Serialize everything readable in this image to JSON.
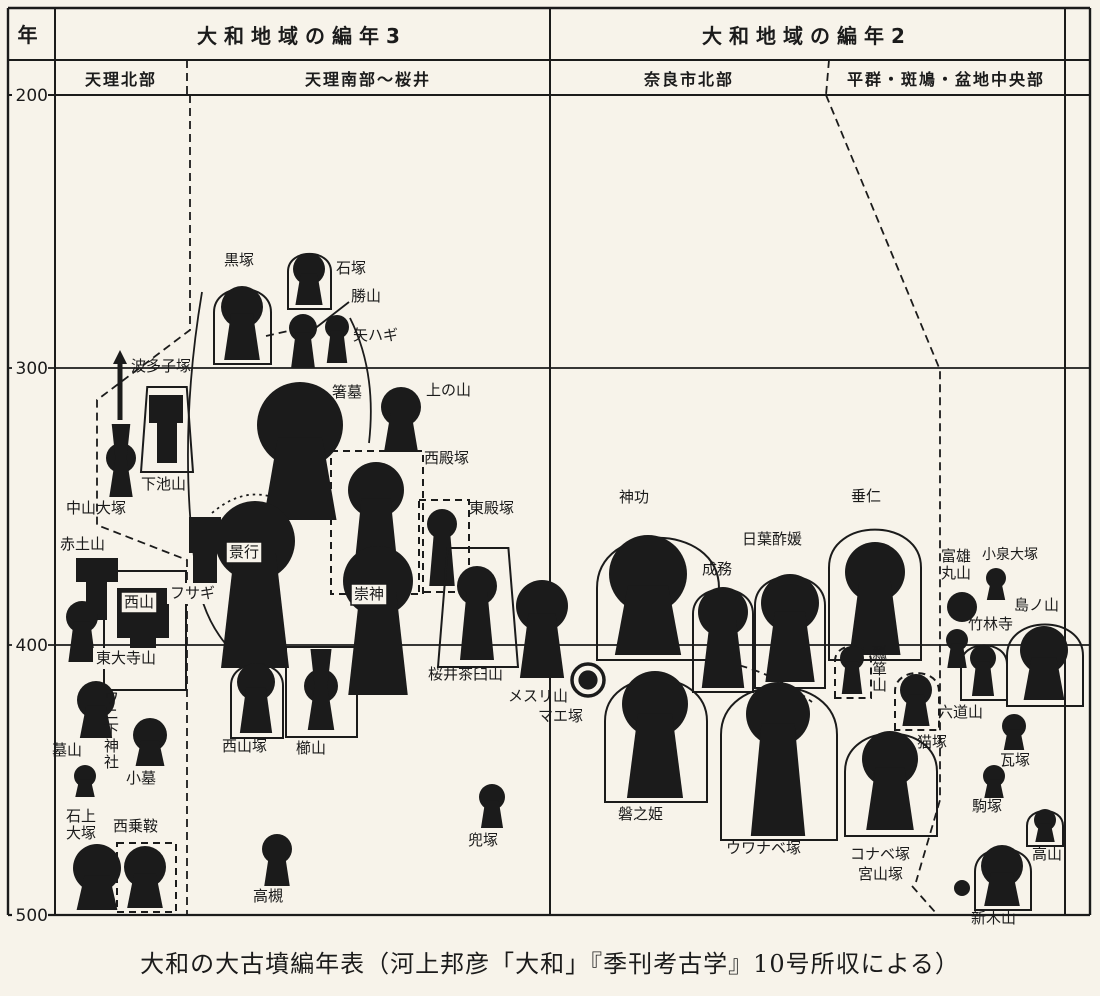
{
  "colors": {
    "paper": "#f7f3ea",
    "ink": "#1b1b1b"
  },
  "caption": "大和の大古墳編年表（河上邦彦「大和」『季刊考古学』10号所収による）",
  "axis": {
    "unit_label": "年",
    "ticks": [
      {
        "label": "200",
        "y": 95
      },
      {
        "label": "300",
        "y": 368
      },
      {
        "label": "400",
        "y": 645
      },
      {
        "label": "500",
        "y": 915
      }
    ]
  },
  "headers": {
    "col_left_title": "大和地域の編年3",
    "col_right_title": "大和地域の編年2",
    "sub_headers": [
      {
        "label": "天理北部",
        "cx": 121
      },
      {
        "label": "天理南部～桜井",
        "cx": 368
      },
      {
        "label": "奈良市北部",
        "cx": 689
      },
      {
        "label": "平群・斑鳩・盆地中央部",
        "cx": 946
      }
    ]
  },
  "tombs": [
    {
      "lb": "波多子塚",
      "t": "a",
      "x": 120,
      "y1": 352,
      "y2": 420,
      "lx": 131,
      "ly": 358
    },
    {
      "lb": "下池山",
      "t": "t",
      "bar": [
        149,
        395,
        34,
        28
      ],
      "col": [
        157,
        423,
        20,
        40
      ],
      "o": {
        "s": "trap",
        "x1": 141,
        "y1": 387,
        "x2": 193,
        "y2": 472
      },
      "lx": 141,
      "ly": 476
    },
    {
      "lb": "中山大塚",
      "t": "h",
      "cx": 121,
      "cy": 458,
      "r": 15,
      "top": 424,
      "b": 497,
      "lx": 66,
      "ly": 500
    },
    {
      "lb": "赤土山",
      "t": "t",
      "bar": [
        76,
        558,
        42,
        24
      ],
      "col": [
        86,
        582,
        21,
        38
      ],
      "lx": 60,
      "ly": 536
    },
    {
      "lb": "西山",
      "t": "t",
      "bar": [
        117,
        588,
        52,
        50
      ],
      "col": [
        130,
        638,
        26,
        18
      ],
      "o": {
        "s": "rect",
        "x1": 104,
        "y1": 571,
        "x2": 186,
        "y2": 690
      },
      "lx": 124,
      "ly": 594,
      "box": "box"
    },
    {
      "lb": "東大寺山",
      "t": "n",
      "lx": 96,
      "ly": 650,
      "box": "bg"
    },
    {
      "lb": "",
      "t": "k",
      "cx": 82,
      "cy": 617,
      "r": 16,
      "b": 662
    },
    {
      "lb": "墓山",
      "t": "k",
      "cx": 96,
      "cy": 700,
      "r": 19,
      "b": 738,
      "lx": 52,
      "ly": 742
    },
    {
      "lb": "ワニ下神社",
      "t": "n",
      "lx": 104,
      "ly": 690,
      "lv": true
    },
    {
      "lb": "小墓",
      "t": "k",
      "cx": 150,
      "cy": 735,
      "r": 17,
      "b": 766,
      "lx": 126,
      "ly": 770
    },
    {
      "lb": "",
      "t": "k",
      "cx": 85,
      "cy": 776,
      "r": 11,
      "b": 797
    },
    {
      "lb": "石上\n大塚",
      "t": "k",
      "cx": 97,
      "cy": 868,
      "r": 24,
      "b": 910,
      "lx": 66,
      "ly": 808,
      "l2": true
    },
    {
      "lb": "西乗鞍",
      "t": "k",
      "cx": 145,
      "cy": 867,
      "r": 21,
      "b": 908,
      "o": {
        "s": "rect",
        "x1": 117,
        "y1": 843,
        "x2": 176,
        "y2": 912,
        "dash": true
      },
      "lx": 113,
      "ly": 818
    },
    {
      "lb": "黒塚",
      "t": "k",
      "cx": 242,
      "cy": 307,
      "r": 21,
      "b": 360,
      "o": {
        "s": "arch",
        "x1": 214,
        "y1": 281,
        "x2": 271,
        "y2": 364
      },
      "lx": 224,
      "ly": 252
    },
    {
      "lb": "石塚",
      "t": "k",
      "cx": 309,
      "cy": 269,
      "r": 16,
      "b": 305,
      "o": {
        "s": "arch",
        "x1": 288,
        "y1": 248,
        "x2": 331,
        "y2": 309
      },
      "lx": 336,
      "ly": 260
    },
    {
      "lb": "勝山",
      "t": "k",
      "cx": 303,
      "cy": 328,
      "r": 14,
      "b": 368,
      "lx": 351,
      "ly": 288
    },
    {
      "lb": "矢ハギ",
      "t": "k",
      "cx": 337,
      "cy": 327,
      "r": 12,
      "b": 363,
      "lx": 353,
      "ly": 327
    },
    {
      "lb": "箸墓",
      "t": "k",
      "cx": 300,
      "cy": 425,
      "r": 43,
      "b": 520,
      "lx": 332,
      "ly": 384
    },
    {
      "lb": "上の山",
      "t": "k",
      "cx": 401,
      "cy": 407,
      "r": 20,
      "b": 452,
      "lx": 426,
      "ly": 382
    },
    {
      "lb": "西殿塚",
      "t": "k",
      "cx": 376,
      "cy": 490,
      "r": 28,
      "b": 588,
      "o": {
        "s": "rect",
        "x1": 331,
        "y1": 451,
        "x2": 423,
        "y2": 594,
        "dash": true
      },
      "lx": 424,
      "ly": 450
    },
    {
      "lb": "東殿塚",
      "t": "k",
      "cx": 442,
      "cy": 524,
      "r": 15,
      "b": 586,
      "o": {
        "s": "rect",
        "x1": 419,
        "y1": 500,
        "x2": 469,
        "y2": 592,
        "dash": true
      },
      "lx": 469,
      "ly": 500
    },
    {
      "lb": "景行",
      "t": "k",
      "cx": 255,
      "cy": 541,
      "r": 40,
      "b": 668,
      "lx": 229,
      "ly": 544,
      "box": "box"
    },
    {
      "lb": "フサギ",
      "t": "t",
      "bar": [
        189,
        517,
        32,
        36
      ],
      "col": [
        193,
        553,
        24,
        46
      ],
      "lx": 170,
      "ly": 585,
      "box": "bg"
    },
    {
      "lb": "崇神",
      "t": "k",
      "cx": 378,
      "cy": 581,
      "r": 35,
      "b": 695,
      "lx": 354,
      "ly": 586,
      "box": "box"
    },
    {
      "lb": "西山塚",
      "t": "k",
      "cx": 256,
      "cy": 682,
      "r": 19,
      "b": 733,
      "o": {
        "s": "arch",
        "x1": 231,
        "y1": 657,
        "x2": 283,
        "y2": 738
      },
      "lx": 222,
      "ly": 738
    },
    {
      "lb": "櫛山",
      "t": "h",
      "cx": 321,
      "cy": 686,
      "r": 17,
      "top": 649,
      "b": 730,
      "o": {
        "s": "rect",
        "x1": 286,
        "y1": 647,
        "x2": 357,
        "y2": 737
      },
      "lx": 296,
      "ly": 740
    },
    {
      "lb": "桜井茶臼山",
      "t": "k",
      "cx": 477,
      "cy": 586,
      "r": 20,
      "b": 660,
      "o": {
        "s": "trap",
        "x1": 438,
        "y1": 548,
        "x2": 518,
        "y2": 667
      },
      "lx": 428,
      "ly": 666
    },
    {
      "lb": "メスリ山",
      "t": "k",
      "cx": 542,
      "cy": 606,
      "r": 26,
      "b": 678,
      "lx": 508,
      "ly": 688
    },
    {
      "lb": "兜塚",
      "t": "k",
      "cx": 492,
      "cy": 797,
      "r": 13,
      "b": 828,
      "lx": 468,
      "ly": 832
    },
    {
      "lb": "高槻",
      "t": "k",
      "cx": 277,
      "cy": 849,
      "r": 15,
      "b": 886,
      "lx": 253,
      "ly": 888
    },
    {
      "lb": "マエ塚",
      "t": "r",
      "cx": 588,
      "cy": 680,
      "r": 16,
      "lx": 538,
      "ly": 708
    },
    {
      "lb": "神功",
      "t": "k",
      "cx": 648,
      "cy": 574,
      "r": 39,
      "b": 655,
      "o": {
        "s": "arch",
        "x1": 597,
        "y1": 521,
        "x2": 719,
        "y2": 660
      },
      "lx": 619,
      "ly": 489
    },
    {
      "lb": "磐之姫",
      "t": "k",
      "cx": 655,
      "cy": 704,
      "r": 33,
      "b": 798,
      "o": {
        "s": "arch",
        "x1": 605,
        "y1": 665,
        "x2": 707,
        "y2": 802
      },
      "lx": 618,
      "ly": 806
    },
    {
      "lb": "成務",
      "t": "k",
      "cx": 723,
      "cy": 612,
      "r": 25,
      "b": 688,
      "o": {
        "s": "arch",
        "x1": 693,
        "y1": 581,
        "x2": 753,
        "y2": 692
      },
      "lx": 702,
      "ly": 561
    },
    {
      "lb": "日葉酢媛",
      "t": "k",
      "cx": 790,
      "cy": 603,
      "r": 29,
      "b": 682,
      "o": {
        "s": "arch",
        "x1": 755,
        "y1": 567,
        "x2": 825,
        "y2": 688
      },
      "lx": 742,
      "ly": 531
    },
    {
      "lb": "垂仁",
      "t": "k",
      "cx": 875,
      "cy": 572,
      "r": 30,
      "b": 655,
      "o": {
        "s": "arch",
        "x1": 829,
        "y1": 517,
        "x2": 921,
        "y2": 660
      },
      "lx": 851,
      "ly": 488
    },
    {
      "lb": "ウワナベ塚",
      "t": "k",
      "cx": 778,
      "cy": 714,
      "r": 32,
      "b": 836,
      "o": {
        "s": "arch",
        "x1": 721,
        "y1": 671,
        "x2": 837,
        "y2": 840
      },
      "lx": 726,
      "ly": 840
    },
    {
      "lb": "コナベ塚",
      "t": "k",
      "cx": 890,
      "cy": 759,
      "r": 28,
      "b": 830,
      "o": {
        "s": "arch",
        "x1": 845,
        "y1": 721,
        "x2": 937,
        "y2": 836
      },
      "lx": 850,
      "ly": 846
    },
    {
      "lb": "瓢箪山",
      "t": "k",
      "cx": 852,
      "cy": 658,
      "r": 12,
      "b": 694,
      "o": {
        "s": "arch",
        "x1": 835,
        "y1": 641,
        "x2": 871,
        "y2": 698,
        "dash": true
      },
      "lx": 872,
      "ly": 645,
      "lv": true
    },
    {
      "lb": "猫塚",
      "t": "k",
      "cx": 916,
      "cy": 690,
      "r": 16,
      "b": 726,
      "o": {
        "s": "arch",
        "x1": 895,
        "y1": 667,
        "x2": 939,
        "y2": 730,
        "dash": true
      },
      "lx": 917,
      "ly": 734
    },
    {
      "lb": "宮山塚",
      "t": "c",
      "cx": 962,
      "cy": 888,
      "r": 8,
      "lx": 858,
      "ly": 866
    },
    {
      "lb": "富雄\n丸山",
      "t": "c",
      "cx": 962,
      "cy": 607,
      "r": 15,
      "lx": 941,
      "ly": 548,
      "l2": true
    },
    {
      "lb": "小泉大塚",
      "t": "k",
      "cx": 996,
      "cy": 578,
      "r": 10,
      "b": 600,
      "lx": 982,
      "ly": 547,
      "fs": 14
    },
    {
      "lb": "竹林寺",
      "t": "k",
      "cx": 957,
      "cy": 640,
      "r": 11,
      "b": 668,
      "lx": 968,
      "ly": 616
    },
    {
      "lb": "島ノ山",
      "t": "k",
      "cx": 1044,
      "cy": 650,
      "r": 24,
      "b": 700,
      "o": {
        "s": "arch",
        "x1": 1007,
        "y1": 614,
        "x2": 1083,
        "y2": 706
      },
      "lx": 1014,
      "ly": 597
    },
    {
      "lb": "六道山",
      "t": "k",
      "cx": 983,
      "cy": 658,
      "r": 13,
      "b": 696,
      "o": {
        "s": "arch",
        "x1": 961,
        "y1": 639,
        "x2": 1007,
        "y2": 700
      },
      "lx": 938,
      "ly": 704
    },
    {
      "lb": "瓦塚",
      "t": "k",
      "cx": 1014,
      "cy": 726,
      "r": 12,
      "b": 750,
      "lx": 1000,
      "ly": 752
    },
    {
      "lb": "駒塚",
      "t": "k",
      "cx": 994,
      "cy": 776,
      "r": 11,
      "b": 798,
      "lx": 972,
      "ly": 798
    },
    {
      "lb": "高山",
      "t": "k",
      "cx": 1045,
      "cy": 820,
      "r": 11,
      "b": 842,
      "o": {
        "s": "arch",
        "x1": 1027,
        "y1": 806,
        "x2": 1063,
        "y2": 846
      },
      "lx": 1032,
      "ly": 846
    },
    {
      "lb": "新木山",
      "t": "k",
      "cx": 1002,
      "cy": 866,
      "r": 21,
      "b": 906,
      "o": {
        "s": "arch",
        "x1": 975,
        "y1": 841,
        "x2": 1031,
        "y2": 910
      },
      "lx": 971,
      "ly": 910
    }
  ],
  "lines": [
    {
      "name": "frame-top",
      "pts": [
        [
          8,
          8
        ],
        [
          1090,
          8
        ]
      ],
      "w": 2.4
    },
    {
      "name": "header-row-divider",
      "pts": [
        [
          8,
          60
        ],
        [
          1090,
          60
        ]
      ],
      "w": 2
    },
    {
      "name": "gridline-200",
      "pts": [
        [
          8,
          95
        ],
        [
          1090,
          95
        ]
      ],
      "w": 2
    },
    {
      "name": "gridline-300",
      "pts": [
        [
          8,
          368
        ],
        [
          1090,
          368
        ]
      ],
      "w": 1.8
    },
    {
      "name": "gridline-400",
      "pts": [
        [
          8,
          645
        ],
        [
          1090,
          645
        ]
      ],
      "w": 1.8
    },
    {
      "name": "gridline-500",
      "pts": [
        [
          8,
          915
        ],
        [
          1090,
          915
        ]
      ],
      "w": 2.2
    },
    {
      "name": "frame-left",
      "pts": [
        [
          8,
          8
        ],
        [
          8,
          915
        ]
      ],
      "w": 2.4
    },
    {
      "name": "year-column-divider",
      "pts": [
        [
          55,
          8
        ],
        [
          55,
          915
        ]
      ],
      "w": 2
    },
    {
      "name": "center-divider",
      "pts": [
        [
          550,
          8
        ],
        [
          550,
          915
        ]
      ],
      "w": 2
    },
    {
      "name": "right-inner-divider",
      "pts": [
        [
          1065,
          8
        ],
        [
          1065,
          915
        ]
      ],
      "w": 2
    },
    {
      "name": "frame-right",
      "pts": [
        [
          1090,
          8
        ],
        [
          1090,
          915
        ]
      ],
      "w": 2.4
    },
    {
      "name": "subheader-divider-left",
      "pts": [
        [
          187,
          60
        ],
        [
          187,
          95
        ]
      ],
      "dash": "dash"
    },
    {
      "name": "subheader-divider-right",
      "pts": [
        [
          829,
          60
        ],
        [
          826,
          95
        ]
      ],
      "dash": "dash"
    },
    {
      "name": "region-boundary-left",
      "pts": [
        [
          190,
          95
        ],
        [
          190,
          330
        ],
        [
          97,
          400
        ],
        [
          97,
          525
        ],
        [
          187,
          560
        ],
        [
          187,
          915
        ]
      ],
      "dash": "dash"
    },
    {
      "name": "region-boundary-right",
      "pts": [
        [
          826,
          95
        ],
        [
          940,
          370
        ],
        [
          940,
          800
        ],
        [
          916,
          882
        ]
      ],
      "dash": "dash"
    },
    {
      "name": "miyayamazuka-leader",
      "pts": [
        [
          912,
          886
        ],
        [
          935,
          912
        ]
      ],
      "dash": "dash"
    },
    {
      "name": "kurozuka-katsuyama-link",
      "pts": [
        [
          266,
          336
        ],
        [
          288,
          331
        ]
      ],
      "dash": "dash"
    },
    {
      "name": "uwanabe-boundary-curve",
      "d": "M714,660 Q768,668 812,702",
      "dash": "dash"
    },
    {
      "name": "keiko-dotted-arc",
      "d": "M212,513 Q254,477 298,511",
      "dash": "dot"
    },
    {
      "name": "katsuyama-leader",
      "pts": [
        [
          349,
          302
        ],
        [
          313,
          330
        ]
      ]
    },
    {
      "name": "makimuku-contour-left",
      "d": "M202,292 Q178,435 195,565 Q201,620 233,652"
    },
    {
      "name": "makimuku-contour-right",
      "d": "M350,318 Q377,372 369,443"
    }
  ]
}
